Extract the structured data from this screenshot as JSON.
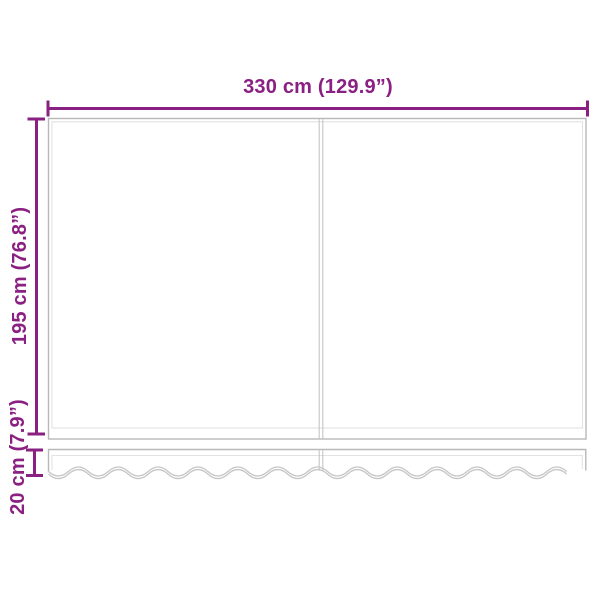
{
  "diagram": {
    "width_dimension": {
      "label": "330 cm (129.9”)"
    },
    "height_dimension": {
      "label": "195 cm (76.8”)"
    },
    "valance_dimension": {
      "label": "20 cm (7.9”)"
    }
  },
  "colors": {
    "dimension_color": "#8a2082",
    "outline_color": "#b8b8b8",
    "outline_light_color": "#e2e2e2",
    "seam_color": "#c6c6c6",
    "background_color": "#ffffff"
  }
}
